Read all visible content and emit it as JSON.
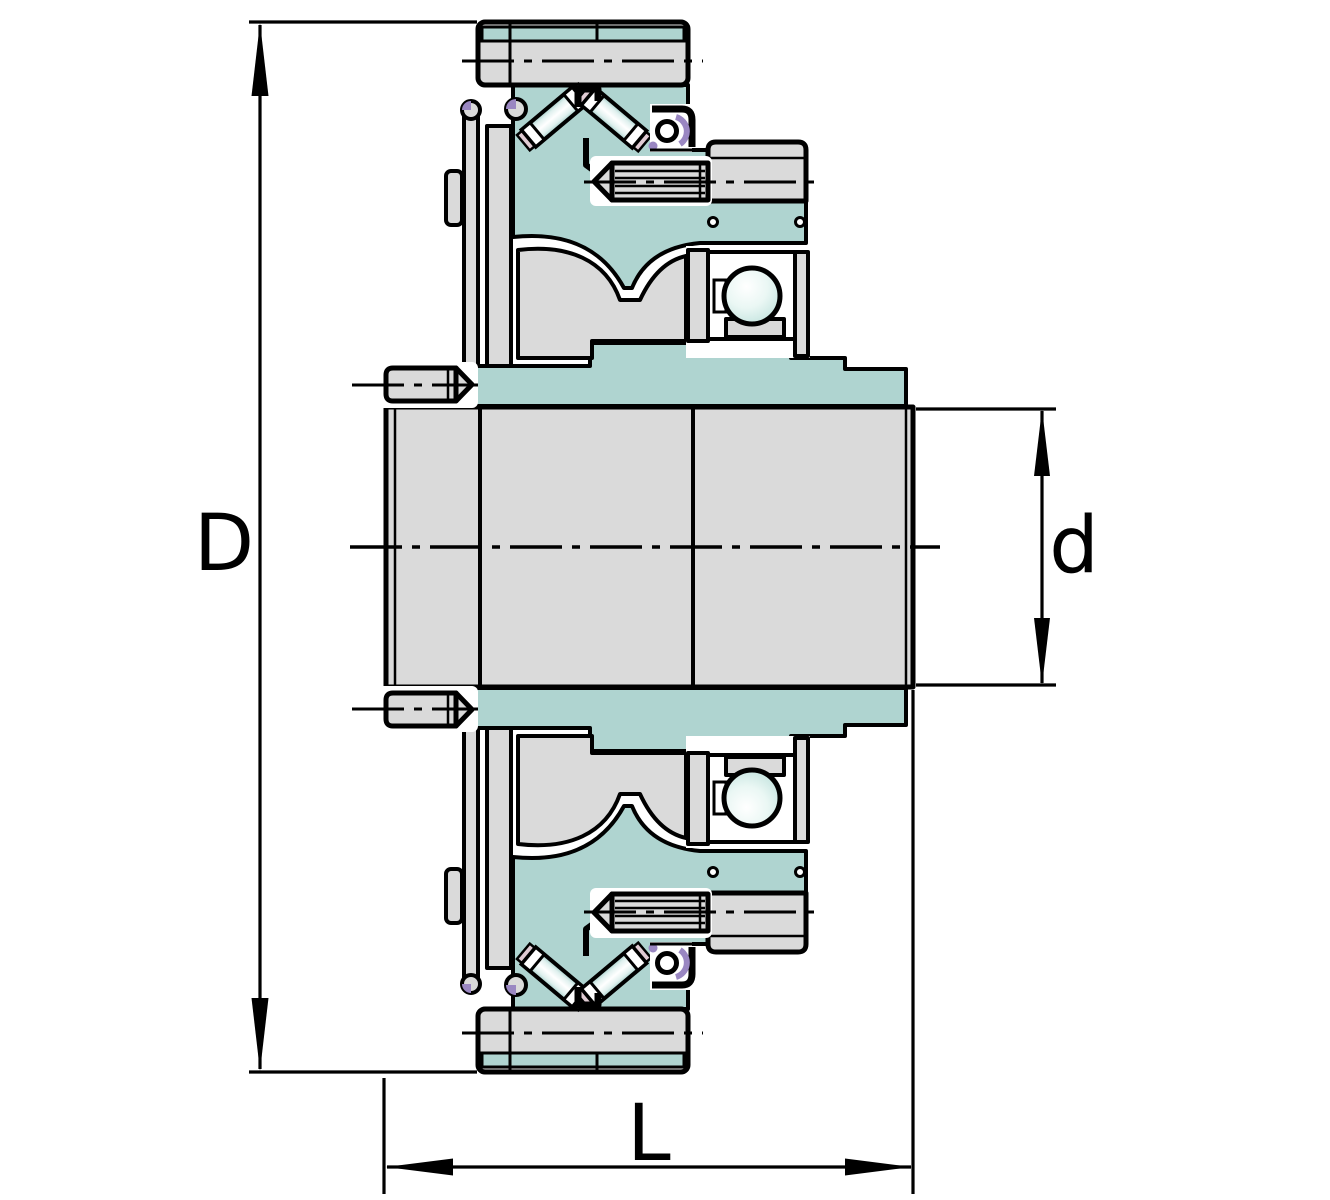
{
  "diagram": {
    "title": "Bearing unit cross-section drawing",
    "labels": {
      "outer_diameter": "D",
      "bore_diameter": "d",
      "overall_length": "L"
    },
    "colors": {
      "housing_teal": "#afd4d0",
      "steel_gray": "#dadada",
      "outline_black": "#000000",
      "seal_purple": "#9a87c2",
      "cage_pink": "#e0cbd3",
      "background": "#ffffff"
    }
  }
}
